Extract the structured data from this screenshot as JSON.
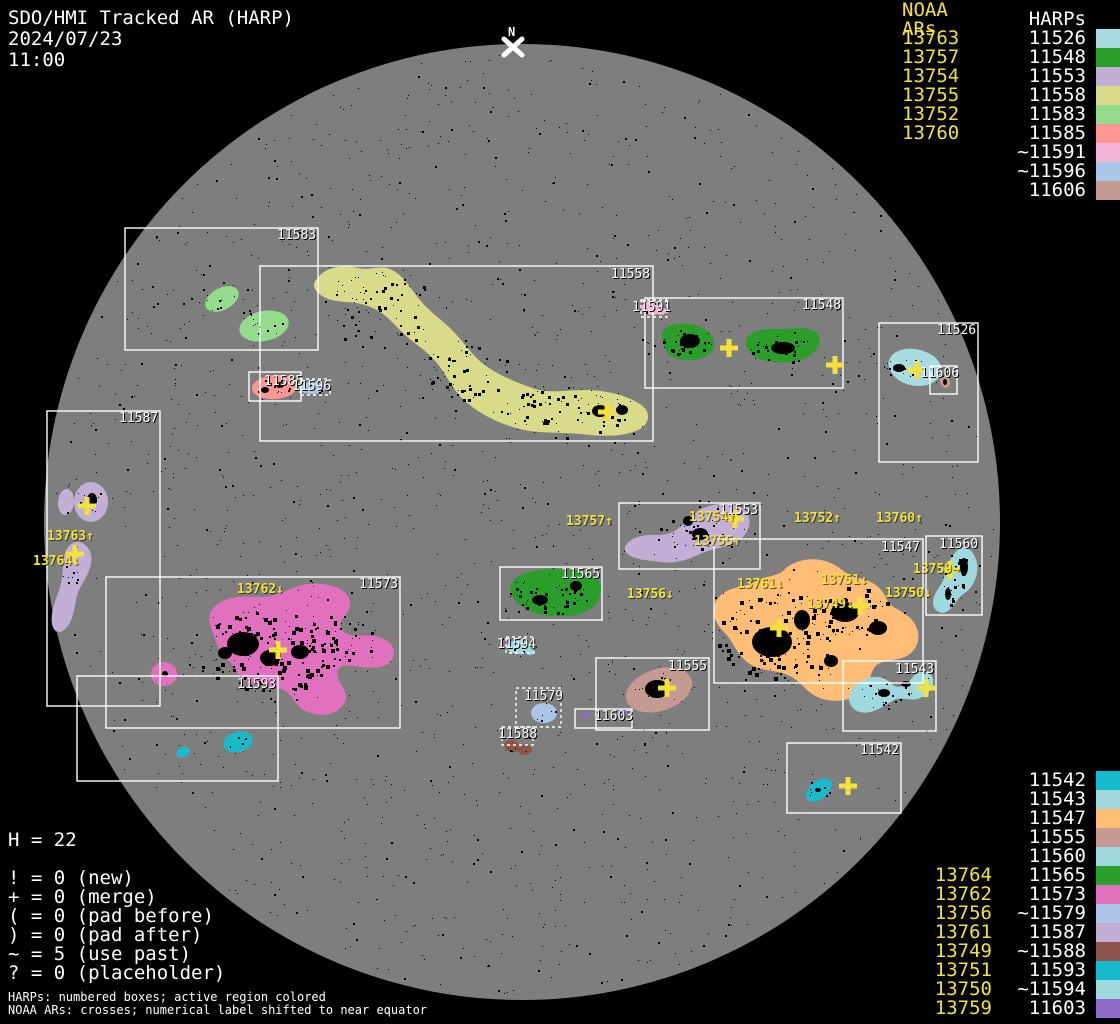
{
  "header": {
    "title": "SDO/HMI Tracked AR (HARP)",
    "date": "2024/07/23",
    "time": "11:00"
  },
  "compass": {
    "label": "N"
  },
  "palette": {
    "background": "#000000",
    "disk": "#7E7E7E",
    "noaa_yellow": "#F3E13C",
    "harp_white": "#FFFFFF"
  },
  "legend_top_right": {
    "noaa_header": "NOAA ARs",
    "harps_header": "HARPs",
    "rows": [
      {
        "noaa": "13763",
        "harp": "11526",
        "color": "#A9DBE3"
      },
      {
        "noaa": "13757",
        "harp": "11548",
        "color": "#2A9D2A"
      },
      {
        "noaa": "13754",
        "harp": "11553",
        "color": "#C3AED6"
      },
      {
        "noaa": "13755",
        "harp": "11558",
        "color": "#D9DB8B"
      },
      {
        "noaa": "13752",
        "harp": "11583",
        "color": "#94DB8E"
      },
      {
        "noaa": "13760",
        "harp": "11585",
        "color": "#FE9794"
      },
      {
        "noaa": "",
        "harp": "~11591",
        "color": "#F4B4D8"
      },
      {
        "noaa": "",
        "harp": "~11596",
        "color": "#ABC7E8"
      },
      {
        "noaa": "",
        "harp": "11606",
        "color": "#C59A92"
      }
    ]
  },
  "legend_bottom_right": {
    "rows": [
      {
        "noaa": "",
        "harp": "11542",
        "color": "#17BBCB"
      },
      {
        "noaa": "",
        "harp": "11543",
        "color": "#A0D8E0"
      },
      {
        "noaa": "",
        "harp": "11547",
        "color": "#FFBD76"
      },
      {
        "noaa": "",
        "harp": "11555",
        "color": "#C59A92"
      },
      {
        "noaa": "",
        "harp": "11560",
        "color": "#A0D8E0"
      },
      {
        "noaa": "13764",
        "harp": "11565",
        "color": "#2A9D2A"
      },
      {
        "noaa": "13762",
        "harp": "11573",
        "color": "#E170BE"
      },
      {
        "noaa": "13756",
        "harp": "~11579",
        "color": "#AEC4E6"
      },
      {
        "noaa": "13761",
        "harp": "11587",
        "color": "#C3AED6"
      },
      {
        "noaa": "13749",
        "harp": "~11588",
        "color": "#8D554B"
      },
      {
        "noaa": "13751",
        "harp": "11593",
        "color": "#17BBCB"
      },
      {
        "noaa": "13750",
        "harp": "~11594",
        "color": "#A0D8E0"
      },
      {
        "noaa": "13759",
        "harp": "11603",
        "color": "#8F6BC8"
      }
    ]
  },
  "stats": {
    "harp_count_label": "H = 22",
    "counters": [
      {
        "symbol": "!",
        "count": "0",
        "desc": "(new)"
      },
      {
        "symbol": "+",
        "count": "0",
        "desc": "(merge)"
      },
      {
        "symbol": "(",
        "count": "0",
        "desc": "(pad before)"
      },
      {
        "symbol": ")",
        "count": "0",
        "desc": "(pad after)"
      },
      {
        "symbol": "~",
        "count": "5",
        "desc": "(use past)"
      },
      {
        "symbol": "?",
        "count": "0",
        "desc": "(placeholder)"
      }
    ]
  },
  "footnotes": [
    "HARPs: numbered boxes; active region colored",
    "NOAA ARs: crosses; numerical label shifted to near equator"
  ],
  "disk_harps": [
    {
      "id": "11583",
      "dashed": false,
      "color": "#94DB8E"
    },
    {
      "id": "11558",
      "dashed": false,
      "color": "#D9DB8B"
    },
    {
      "id": "11548",
      "dashed": false,
      "color": "#2A9D2A"
    },
    {
      "id": "11591",
      "dashed": true,
      "color": "#F4B4D8"
    },
    {
      "id": "11526",
      "dashed": false,
      "color": "#A9DBE3"
    },
    {
      "id": "11606",
      "dashed": false,
      "color": "#C59A92"
    },
    {
      "id": "11585",
      "dashed": false,
      "color": "#FE9794"
    },
    {
      "id": "11596",
      "dashed": true,
      "color": "#ABC7E8"
    },
    {
      "id": "11587",
      "dashed": false,
      "color": "#C3AED6"
    },
    {
      "id": "11553",
      "dashed": false,
      "color": "#C3AED6"
    },
    {
      "id": "11565",
      "dashed": false,
      "color": "#2A9D2A"
    },
    {
      "id": "11547",
      "dashed": false,
      "color": "#FFBD76"
    },
    {
      "id": "11560",
      "dashed": false,
      "color": "#A0D8E0"
    },
    {
      "id": "11573",
      "dashed": false,
      "color": "#E170BE"
    },
    {
      "id": "11593",
      "dashed": false,
      "color": "#17BBCB"
    },
    {
      "id": "11555",
      "dashed": false,
      "color": "#C59A92"
    },
    {
      "id": "11543",
      "dashed": false,
      "color": "#A0D8E0"
    },
    {
      "id": "11542",
      "dashed": false,
      "color": "#17BBCB"
    },
    {
      "id": "11594",
      "dashed": true,
      "color": "#A0D8E0"
    },
    {
      "id": "11579",
      "dashed": true,
      "color": "#AEC4E6"
    },
    {
      "id": "11588",
      "dashed": true,
      "color": "#8D554B"
    },
    {
      "id": "11603",
      "dashed": false,
      "color": "#8F6BC8"
    }
  ],
  "disk_noaa": [
    {
      "id": "13763",
      "arrow": "↑"
    },
    {
      "id": "13764",
      "arrow": "↓"
    },
    {
      "id": "13757",
      "arrow": "↑"
    },
    {
      "id": "13754",
      "arrow": "↑"
    },
    {
      "id": "13755",
      "arrow": "↑"
    },
    {
      "id": "13752",
      "arrow": "↑"
    },
    {
      "id": "13760",
      "arrow": "↑"
    },
    {
      "id": "13762",
      "arrow": "↓"
    },
    {
      "id": "13756",
      "arrow": "↓"
    },
    {
      "id": "13761",
      "arrow": "↓"
    },
    {
      "id": "13751",
      "arrow": "↓"
    },
    {
      "id": "13750",
      "arrow": "↓"
    },
    {
      "id": "13749",
      "arrow": "↓"
    },
    {
      "id": "13759",
      "arrow": "→"
    }
  ]
}
